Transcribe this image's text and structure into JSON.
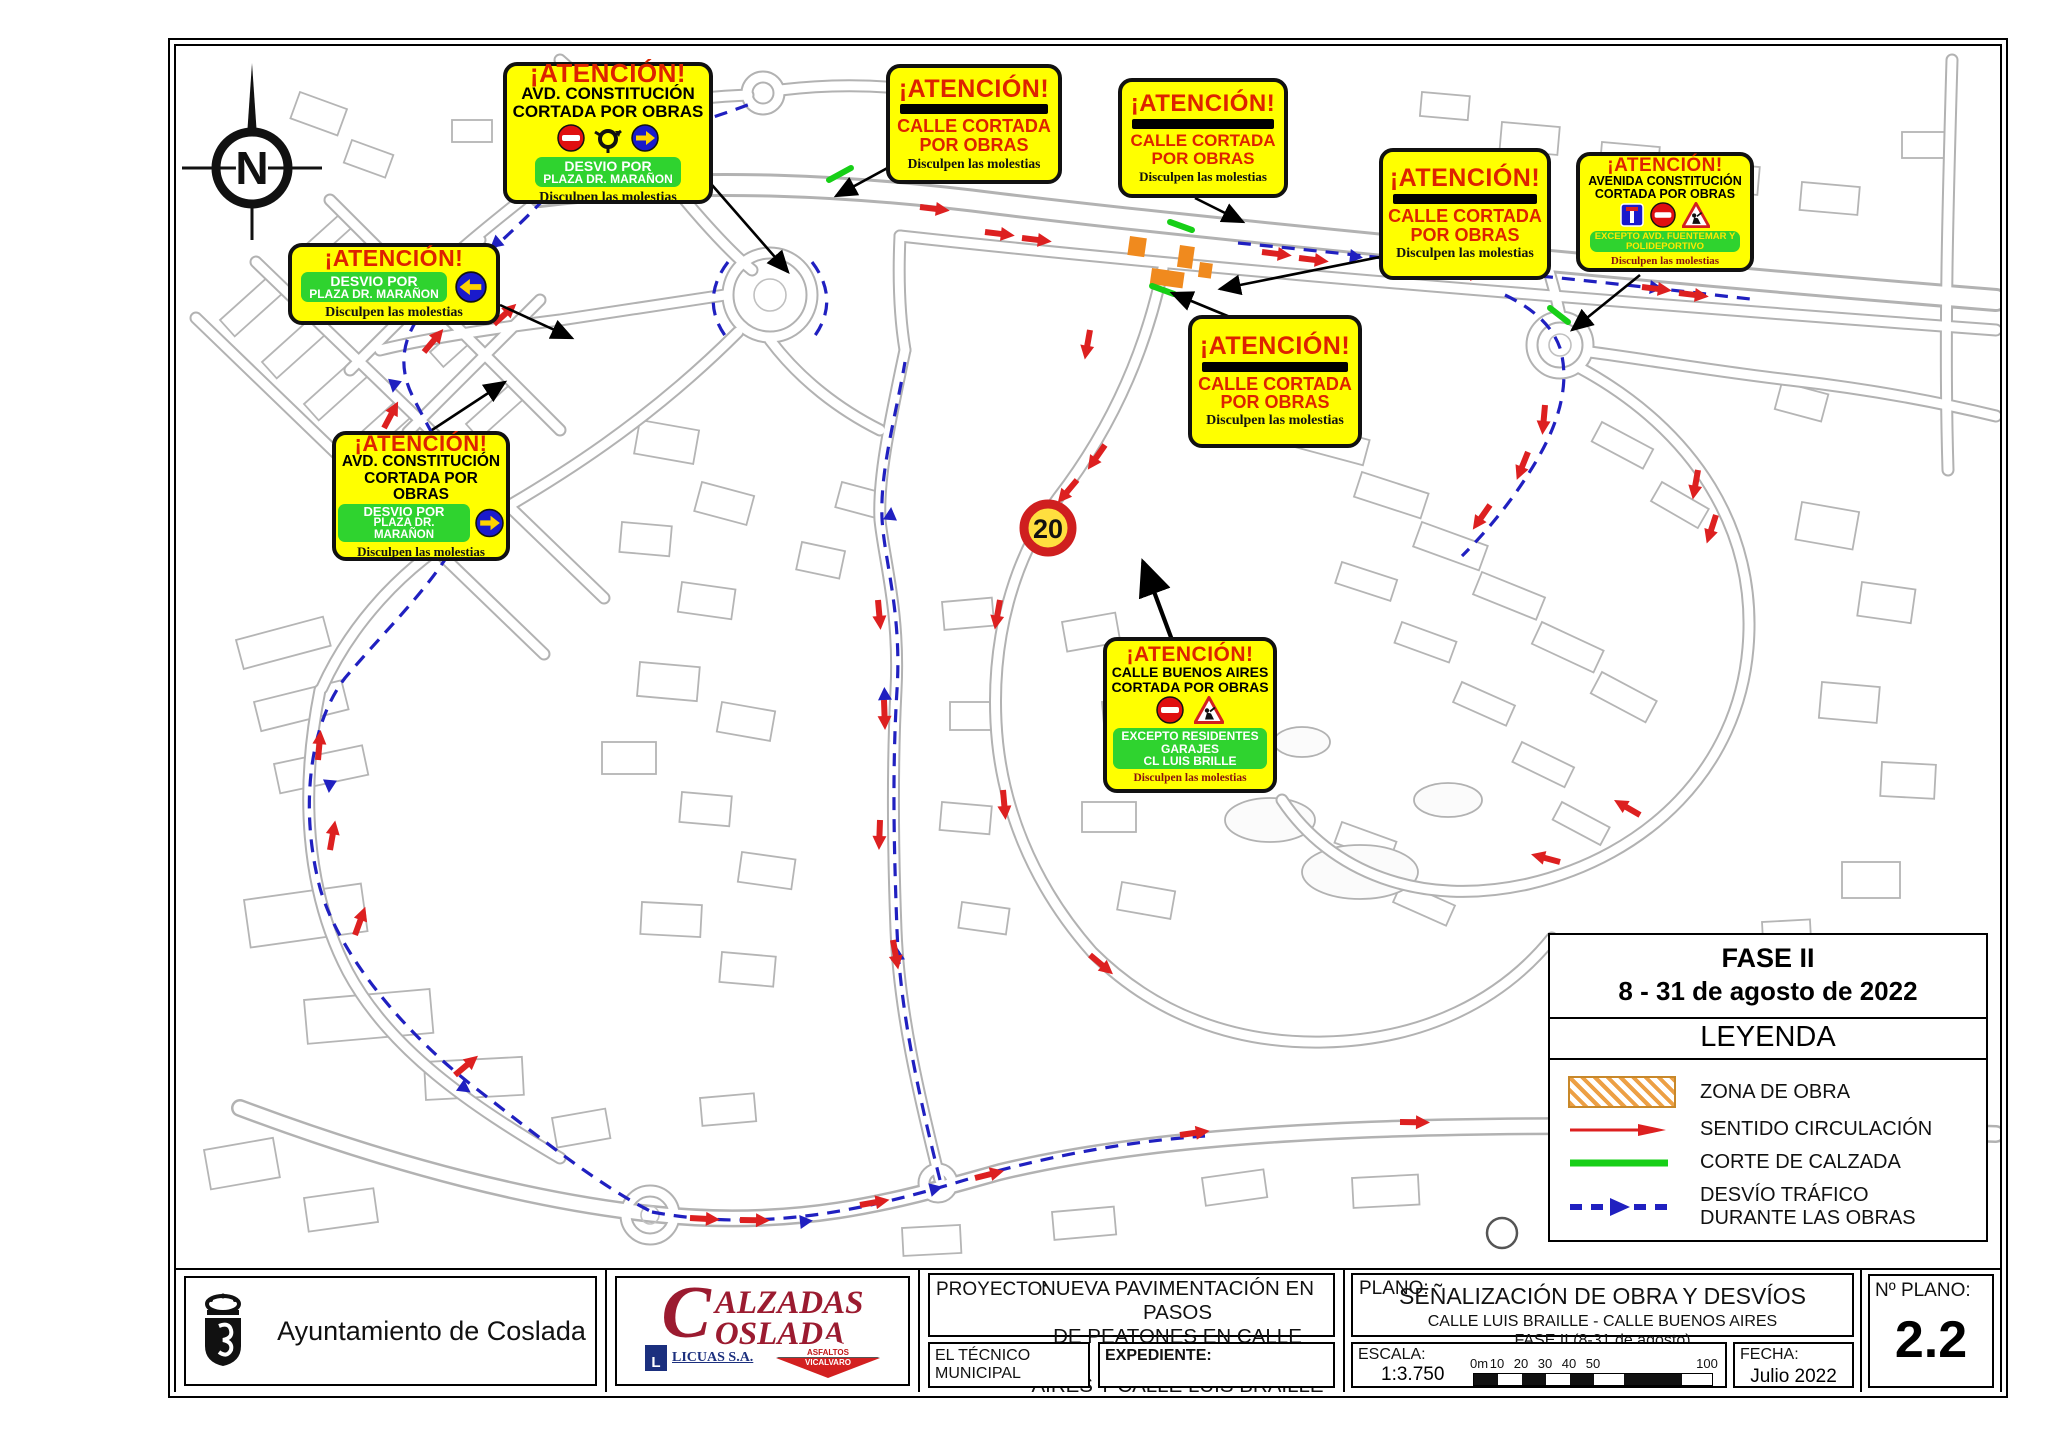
{
  "page": {
    "width": 2048,
    "height": 1448
  },
  "colors": {
    "sign_yellow": "#ffff00",
    "attention_red": "#dd2200",
    "detour_green": "#2fd32f",
    "arrow_circle_blue": "#1a1acc",
    "arrow_yellow": "#ffd400",
    "work_zone_orange": "#f08a1e",
    "traffic_arrow_red": "#dd2020",
    "road_cut_green": "#17cf17",
    "detour_route_blue": "#2020c0",
    "map_line_gray": "#b2b2b2"
  },
  "map": {
    "compass_label": "N",
    "speed_limit": "20"
  },
  "signs": {
    "a": {
      "title": "¡ATENCIÓN!",
      "line1": "AVD. CONSTITUCIÓN",
      "line2": "CORTADA POR OBRAS",
      "green1": "DESVIO POR",
      "green2": "PLAZA DR. MARAÑON",
      "footer": "Disculpen las molestias"
    },
    "b": {
      "title": "¡ATENCIÓN!",
      "line1": "CALLE CORTADA",
      "line2": "POR OBRAS",
      "footer": "Disculpen las molestias"
    },
    "c": {
      "title": "¡ATENCIÓN!",
      "line1": "CALLE CORTADA",
      "line2": "POR OBRAS",
      "footer": "Disculpen las molestias"
    },
    "d": {
      "title": "¡ATENCIÓN!",
      "line1": "CALLE CORTADA",
      "line2": "POR OBRAS",
      "footer": "Disculpen las molestias"
    },
    "e": {
      "title": "¡ATENCIÓN!",
      "line1": "AVENIDA CONSTITUCIÓN",
      "line2": "CORTADA POR OBRAS",
      "green1": "EXCEPTO AVD. FUENTEMAR Y",
      "green2": "POLIDEPORTIVO",
      "footer": "Disculpen las molestias"
    },
    "f": {
      "title": "¡ATENCIÓN!",
      "green1": "DESVIO POR",
      "green2": "PLAZA DR. MARAÑON",
      "footer": "Disculpen las molestias"
    },
    "g": {
      "title": "¡ATENCIÓN!",
      "line1": "CALLE CORTADA",
      "line2": "POR OBRAS",
      "footer": "Disculpen las molestias"
    },
    "h": {
      "title": "¡ATENCIÓN!",
      "line1": "AVD. CONSTITUCIÓN",
      "line2": "CORTADA POR OBRAS",
      "green1": "DESVIO POR",
      "green2": "PLAZA DR. MARAÑON",
      "footer": "Disculpen las molestias"
    },
    "i": {
      "title": "¡ATENCIÓN!",
      "line1": "CALLE BUENOS AIRES",
      "line2": "CORTADA POR OBRAS",
      "green1": "EXCEPTO RESIDENTES",
      "green2": "GARAJES",
      "green3": "CL LUIS BRILLE",
      "footer": "Disculpen las molestias"
    }
  },
  "legend": {
    "phase": "FASE II",
    "dates": "8 - 31 de agosto de 2022",
    "header": "LEYENDA",
    "items": [
      {
        "label": "ZONA DE OBRA"
      },
      {
        "label": "SENTIDO CIRCULACIÓN"
      },
      {
        "label": "CORTE DE CALZADA"
      },
      {
        "label": "DESVÍO TRÁFICO",
        "label2": "DURANTE LAS OBRAS"
      }
    ]
  },
  "title_block": {
    "municipality": "Ayuntamiento de Coslada",
    "contractor": {
      "initial": "C",
      "name_top": "ALZADAS",
      "name_bottom": "OSLADA",
      "partner1": "LICUAS S.A.",
      "partner1_initial": "L",
      "partner2_top": "ASFALTOS",
      "partner2_bottom": "VICALVARO"
    },
    "proyecto_label": "PROYECTO:",
    "proyecto_line1": "NUEVA PAVIMENTACIÓN EN PASOS",
    "proyecto_line2": "DE PEATONES EN CALLE BUENOS",
    "proyecto_line3": "AIRES Y CALLE LUIS BRAILLE",
    "tecnico_label": "EL TÉCNICO MUNICIPAL",
    "expediente_label": "EXPEDIENTE:",
    "plano_label": "PLANO:",
    "plano_line1": "SEÑALIZACIÓN DE OBRA Y DESVÍOS",
    "plano_line2": "CALLE LUIS BRAILLE - CALLE BUENOS AIRES",
    "plano_line3": "FASE II (8-31 de agosto)",
    "escala_label": "ESCALA:",
    "escala_value": "1:3.750",
    "scale_ticks": [
      "0m",
      "10",
      "20",
      "30",
      "40",
      "50",
      "100"
    ],
    "fecha_label": "FECHA:",
    "fecha_value": "Julio 2022",
    "num_label": "Nº PLANO:",
    "num_value": "2.2"
  }
}
